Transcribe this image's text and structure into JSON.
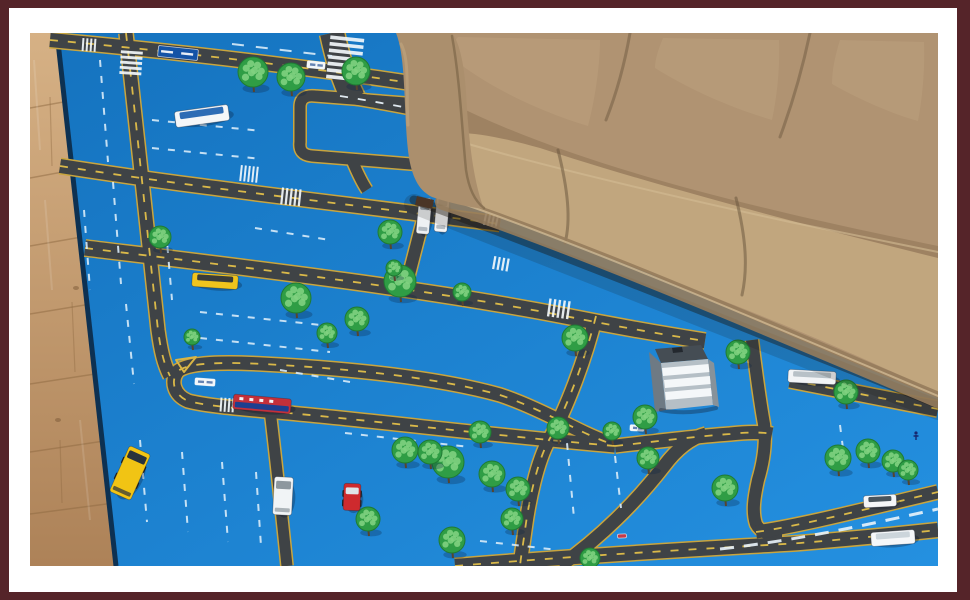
{
  "colors": {
    "frame_border": "#552429",
    "page_bg": "#ffffff",
    "mat_blue": "#1573bf",
    "mat_blue_light": "#2490e0",
    "mat_edge": "#0d3152",
    "road": "#3f4346",
    "road_edge": "#c9a53e",
    "dash_yellow": "#e3c04a",
    "dash_white": "#e8f2fa",
    "lane_dash": "#d8ebf8",
    "crosswalk": "#f2f7fb",
    "tree_green": "#2f9d45",
    "tree_light": "#7fd27f",
    "tree_trunk": "#57452e",
    "tree_stroke": "#1f7a33",
    "wood_light": "#d6b185",
    "wood_dark": "#ad8258",
    "wood_seam": "#8f6a42",
    "couch_body": "#b09372",
    "couch_seat": "#c1a67e",
    "couch_arm": "#ab8f6d",
    "couch_crease": "#6e5940",
    "couch_skirt": "#967c5c",
    "couch_piping": "#d9c29a",
    "couch_back_shadow": "#8b7152"
  },
  "photo": {
    "x": 30,
    "y": 33,
    "width": 908,
    "height": 533
  },
  "scene": {
    "floor": {
      "polygon": "30,33 57,33 116,566 30,566",
      "seams": [
        [
          30,
          108,
          91,
          97
        ],
        [
          30,
          178,
          95,
          166
        ],
        [
          30,
          246,
          99,
          234
        ],
        [
          30,
          314,
          103,
          302
        ],
        [
          30,
          384,
          108,
          372
        ],
        [
          30,
          452,
          111,
          440
        ],
        [
          30,
          514,
          114,
          503
        ]
      ],
      "joints": [
        [
          50,
          97,
          52,
          166
        ],
        [
          72,
          302,
          75,
          372
        ],
        [
          60,
          440,
          62,
          503
        ]
      ],
      "streaks": [
        [
          34,
          60,
          40,
          150
        ],
        [
          45,
          200,
          52,
          290
        ],
        [
          80,
          420,
          90,
          520
        ]
      ],
      "knots": [
        [
          76,
          288
        ],
        [
          58,
          420
        ]
      ]
    },
    "mat": {
      "polygon": "57,33 938,33 938,566 116,566",
      "edge": "M57,33 L116,566"
    },
    "roads": [
      {
        "d": "M50,40 C180,52 320,68 455,90",
        "w": 14,
        "c": "y"
      },
      {
        "d": "M340,96 C390,104 432,112 472,122",
        "w": 12,
        "c": "w"
      },
      {
        "d": "M60,166 C200,188 340,203 500,224",
        "w": 14,
        "c": "y"
      },
      {
        "d": "M424,216 C418,240 412,262 406,286",
        "w": 12
      },
      {
        "d": "M300,107 C300,98 306,95 315,96 L418,104 C428,105 432,110 431,118 L427,152 C426,161 420,165 411,164 L312,156 C302,155 299,150 300,142 Z",
        "w": 11
      },
      {
        "d": "M126,33 C136,120 148,240 158,330 C161,352 164,364 170,376",
        "w": 13,
        "c": "y"
      },
      {
        "d": "M332,33 C338,60 344,80 353,98",
        "w": 24
      },
      {
        "d": "M352,160 C357,172 361,181 367,190",
        "w": 11
      },
      {
        "d": "M85,248 C250,268 420,288 565,316 C620,327 660,334 705,341",
        "w": 15,
        "c": "y"
      },
      {
        "d": "M790,380 C840,390 890,400 938,409",
        "w": 15,
        "c": "y"
      },
      {
        "d": "M615,446 C500,436 420,426 320,416 C260,410 210,407 188,401 C174,395 170,381 178,371 C188,363 220,361 280,365 C380,371 450,381 500,395 C530,405 560,421 585,433 C598,439 608,443 615,445",
        "w": 13,
        "c": "y"
      },
      {
        "d": "M615,446 C660,441 700,436 730,434 C748,432 762,432 772,434",
        "w": 13,
        "c": "y"
      },
      {
        "d": "M596,316 C585,360 566,410 549,440 C537,462 529,500 525,530 C523,545 521,556 520,566",
        "w": 13,
        "c": "y"
      },
      {
        "d": "M560,566 C600,538 636,502 664,466 C676,450 690,438 706,434",
        "w": 13
      },
      {
        "d": "M752,340 C756,372 760,402 764,424 C766,440 764,460 758,480 C754,498 752,512 756,524 C760,532 770,536 782,536",
        "w": 12
      },
      {
        "d": "M756,532 C800,526 870,508 938,492",
        "w": 13,
        "c": "y"
      },
      {
        "d": "M455,566 C600,554 720,548 800,543 C860,538 910,533 938,530",
        "w": 14,
        "c": "y"
      },
      {
        "d": "M270,410 C277,468 282,518 287,566",
        "w": 11
      }
    ],
    "crosswalks": [
      [
        131,
        64,
        22,
        26,
        4,
        5,
        1
      ],
      [
        345,
        60,
        34,
        46,
        6,
        7,
        1
      ],
      [
        250,
        174,
        20,
        16,
        6,
        5,
        0
      ],
      [
        292,
        197,
        22,
        17,
        6,
        5,
        0
      ],
      [
        560,
        309,
        24,
        18,
        8,
        5,
        0
      ],
      [
        228,
        405,
        16,
        14,
        4,
        4,
        0
      ],
      [
        90,
        45,
        16,
        13,
        4,
        4,
        0
      ],
      [
        492,
        220,
        16,
        13,
        12,
        4,
        0
      ],
      [
        502,
        264,
        18,
        13,
        10,
        4,
        0
      ]
    ],
    "lane_dashes": [
      {
        "d": "M100,60 L108,162"
      },
      {
        "d": "M113,182 L121,284"
      },
      {
        "d": "M126,304 L134,384"
      },
      {
        "d": "M232,44 L332,56",
        "da": "12 12"
      },
      {
        "d": "M152,120 L262,131"
      },
      {
        "d": "M152,148 L262,159"
      },
      {
        "d": "M440,130 L556,147"
      },
      {
        "d": "M200,312 L330,326"
      },
      {
        "d": "M200,338 L330,352"
      },
      {
        "d": "M255,228 L330,240"
      },
      {
        "d": "M166,230 L172,300"
      },
      {
        "d": "M345,433 L470,447"
      },
      {
        "d": "M140,440 L147,522"
      },
      {
        "d": "M182,452 L188,532"
      },
      {
        "d": "M222,462 L228,542"
      },
      {
        "d": "M256,472 L261,546"
      },
      {
        "d": "M567,443 L574,518"
      },
      {
        "d": "M615,456 L621,508"
      },
      {
        "d": "M840,425 L846,472"
      },
      {
        "d": "M480,541 L558,550"
      },
      {
        "d": "M84,210 L90,290"
      },
      {
        "d": "M280,370 L350,382"
      },
      {
        "d": "M720,549 C800,540 870,524 938,509",
        "da": "14 10",
        "w": 3,
        "c": "#eaf4fb"
      }
    ],
    "island": {
      "d": "M176,360 L196,357 L184,372 Z",
      "stroke": "#d9b545"
    },
    "signs": [
      {
        "x": 178,
        "y": 53,
        "w": 40,
        "h": 11,
        "a": 6,
        "fill": "#1453a6",
        "marks": "#ffffff"
      },
      {
        "x": 316,
        "y": 65,
        "w": 18,
        "h": 7,
        "a": 6,
        "fill": "#f2f6f9",
        "marks": "#5577aa"
      },
      {
        "x": 205,
        "y": 382,
        "w": 20,
        "h": 7,
        "a": 4,
        "fill": "#f2f6f9",
        "marks": "#5577aa"
      },
      {
        "x": 637,
        "y": 428,
        "w": 14,
        "h": 6,
        "a": 3,
        "fill": "#f2f6f9",
        "marks": "#5577aa"
      },
      {
        "x": 622,
        "y": 536,
        "w": 9,
        "h": 4,
        "a": -3,
        "fill": "#c43b4a"
      }
    ],
    "building": {
      "paths": [
        {
          "d": "M649,352 L661,363 L666,410 L655,412 Z",
          "fill": "#6e7a84"
        },
        {
          "d": "M655,349 L701,345 L708,359 L661,363 Z",
          "fill": "#454d54"
        },
        {
          "d": "M672,348 L682,347 L683,352 L673,353 Z",
          "fill": "#23282e"
        },
        {
          "d": "M661,363 L708,359 L713,405 L666,410 Z",
          "fill": "#b5bfc6"
        },
        {
          "d": "M662,368 L709,364 L710,372 L663,376 Z",
          "fill": "#f4f7f9"
        },
        {
          "d": "M664,380 L710,376 L711,384 L665,388 Z",
          "fill": "#f4f7f9"
        },
        {
          "d": "M665,392 L711,388 L712,396 L666,400 Z",
          "fill": "#f4f7f9"
        },
        {
          "d": "M708,359 L714,363 L719,407 L713,405 Z",
          "fill": "#87929a"
        },
        {
          "d": "M661,410 C680,414 700,412 716,408",
          "stroke": "rgba(20,30,45,0.35)",
          "w": 4
        }
      ]
    },
    "trees": [
      [
        253,
        72,
        15
      ],
      [
        291,
        77,
        14
      ],
      [
        356,
        71,
        14
      ],
      [
        390,
        232,
        12
      ],
      [
        160,
        237,
        11
      ],
      [
        296,
        298,
        15
      ],
      [
        400,
        281,
        16
      ],
      [
        357,
        319,
        12
      ],
      [
        327,
        333,
        10
      ],
      [
        192,
        337,
        8
      ],
      [
        575,
        338,
        13
      ],
      [
        738,
        352,
        12
      ],
      [
        645,
        417,
        12
      ],
      [
        558,
        428,
        11
      ],
      [
        405,
        450,
        13
      ],
      [
        448,
        462,
        16
      ],
      [
        492,
        474,
        13
      ],
      [
        518,
        489,
        12
      ],
      [
        368,
        519,
        12
      ],
      [
        452,
        540,
        13
      ],
      [
        512,
        519,
        11
      ],
      [
        612,
        431,
        9
      ],
      [
        648,
        458,
        11
      ],
      [
        725,
        488,
        13
      ],
      [
        838,
        458,
        13
      ],
      [
        868,
        451,
        12
      ],
      [
        893,
        461,
        11
      ],
      [
        846,
        392,
        12
      ],
      [
        590,
        558,
        10
      ],
      [
        480,
        432,
        11
      ],
      [
        430,
        452,
        12
      ],
      [
        908,
        470,
        10
      ],
      [
        394,
        268,
        8
      ],
      [
        462,
        292,
        9
      ]
    ],
    "pedestrians": [
      [
        916,
        437
      ]
    ],
    "vehicles": [
      {
        "name": "toy-white-bus",
        "x": 202,
        "y": 116,
        "w": 54,
        "h": 16,
        "a": -8,
        "body": "#f4f6f8",
        "win": "#2d6cb5"
      },
      {
        "name": "toy-white-truck-a",
        "x": 424,
        "y": 216,
        "w": 13,
        "h": 36,
        "a": 5,
        "body": "#eef1f3",
        "win": "#9aa4ac",
        "rear": 1
      },
      {
        "name": "toy-white-truck-b",
        "x": 442,
        "y": 213,
        "w": 13,
        "h": 38,
        "a": 5,
        "body": "#f3f5f7",
        "win": "#9aa4ac",
        "rear": 1
      },
      {
        "name": "toy-school-bus",
        "x": 215,
        "y": 281,
        "w": 46,
        "h": 14,
        "a": 4,
        "body": "#f0c41d",
        "win": "#3a3d3a"
      },
      {
        "name": "toy-train",
        "x": 262,
        "y": 404,
        "w": 58,
        "h": 15,
        "a": 5,
        "body": "#c4303a",
        "band": "#1d3f8f",
        "dots": 1
      },
      {
        "name": "toy-taxi",
        "x": 130,
        "y": 473,
        "w": 23,
        "h": 50,
        "a": 24,
        "body": "#f1c414",
        "win": "#28323c",
        "wheels": 1,
        "rear": 1
      },
      {
        "name": "toy-white-van",
        "x": 283,
        "y": 496,
        "w": 19,
        "h": 38,
        "a": 3,
        "body": "#f1f4f6",
        "win": "#8d979e",
        "rear": 1
      },
      {
        "name": "toy-red-car",
        "x": 352,
        "y": 497,
        "w": 17,
        "h": 27,
        "a": 2,
        "body": "#ce2a2e",
        "win": "#dfe4e8",
        "wheels": 1
      },
      {
        "name": "toy-white-bus-2",
        "x": 812,
        "y": 377,
        "w": 48,
        "h": 13,
        "a": 3,
        "body": "#f2f4f6",
        "win": "#b8c1c7"
      },
      {
        "name": "toy-white-car",
        "x": 880,
        "y": 501,
        "w": 33,
        "h": 12,
        "a": -3,
        "body": "#f4f6f8",
        "win": "#49545c"
      },
      {
        "name": "toy-white-truck-c",
        "x": 893,
        "y": 538,
        "w": 44,
        "h": 14,
        "a": -4,
        "body": "#f5f7f9",
        "win": "#ccd5db"
      }
    ],
    "shadows": [
      {
        "d": "M414,200 C520,238 700,310 938,404",
        "stroke": "rgba(25,18,10,0.40)",
        "w": 9
      },
      {
        "d": "M414,204 C520,244 700,316 938,410",
        "stroke": "rgba(25,18,10,0.16)",
        "w": 20
      }
    ],
    "couch": {
      "paths": [
        {
          "d": "M396,33 L938,33 L938,398 C850,362 740,314 650,274 C560,238 478,210 438,195 C416,158 406,90 401,33 Z",
          "fill": "#b09372",
          "name": "couch-body"
        },
        {
          "d": "M448,55 C485,85 535,110 588,126 C596,95 600,62 600,40 L458,37 C452,44 448,50 448,55 Z",
          "fill": "#c0a481",
          "o": 0.45,
          "name": "back-cushion-1"
        },
        {
          "d": "M655,68 C695,93 738,110 772,120 C778,92 780,62 779,40 L663,38 C658,50 655,60 655,68 Z",
          "fill": "#c0a481",
          "o": 0.4,
          "name": "back-cushion-2"
        },
        {
          "d": "M832,84 C862,101 893,114 918,121 C923,95 925,65 924,42 L840,40 C835,56 832,70 832,84 Z",
          "fill": "#c0a481",
          "o": 0.4,
          "name": "back-cushion-3"
        },
        {
          "d": "M630,33 C625,62 617,92 606,120",
          "stroke": "#6e5940",
          "w": 3,
          "o": 0.5,
          "name": "back-crease-1"
        },
        {
          "d": "M810,33 C803,66 793,102 780,137",
          "stroke": "#6e5940",
          "w": 3,
          "o": 0.5,
          "name": "back-crease-2"
        },
        {
          "d": "M406,78 C520,148 700,198 938,246 L938,286 C700,236 520,184 428,134 C418,116 410,96 406,78 Z",
          "fill": "#8b7152",
          "o": 0.5,
          "name": "back-seat-shadow"
        },
        {
          "d": "M447,196 C520,224 610,258 690,288 C780,322 880,364 938,394 L938,258 C800,224 650,184 540,148 C490,134 458,130 444,135 C437,158 440,178 447,196 Z",
          "fill": "#c1a67e",
          "name": "seat-cushions"
        },
        {
          "d": "M441,136 C540,166 680,198 790,222 C860,236 910,246 938,252",
          "stroke": "#d3bc94",
          "w": 2,
          "o": 0.6,
          "name": "seat-top-piping"
        },
        {
          "d": "M558,150 C568,190 571,220 565,243",
          "stroke": "#6e5940",
          "w": 3,
          "o": 0.55,
          "name": "seat-seam-1"
        },
        {
          "d": "M736,198 C746,238 748,268 742,295",
          "stroke": "#6e5940",
          "w": 3,
          "o": 0.55,
          "name": "seat-seam-2"
        },
        {
          "d": "M443,202 C560,240 740,316 938,400",
          "stroke": "#967c5c",
          "w": 16,
          "o": 0.9,
          "name": "couch-skirt"
        },
        {
          "d": "M443,197 C560,236 740,312 938,396",
          "stroke": "#d9c29a",
          "w": 2,
          "o": 0.7,
          "name": "front-piping"
        },
        {
          "d": "M396,33 C407,60 403,118 409,158 C413,180 420,191 432,197 C450,203 468,207 484,209 C472,178 468,130 466,92 C464,60 458,40 452,33 Z",
          "fill": "#ab8f6d",
          "name": "couch-arm"
        },
        {
          "d": "M452,36 C460,80 462,130 466,170 C469,190 476,202 484,208",
          "stroke": "#7a6446",
          "w": 2.5,
          "o": 0.65,
          "name": "arm-crease"
        },
        {
          "d": "M401,44 C410,60 406,95 408,125",
          "stroke": "#c6ab83",
          "w": 3,
          "o": 0.5,
          "name": "arm-highlight"
        },
        {
          "d": "M417,196 L434,200 L432,209 L415,205 Z",
          "fill": "#4a3526",
          "name": "couch-leg"
        }
      ]
    }
  }
}
